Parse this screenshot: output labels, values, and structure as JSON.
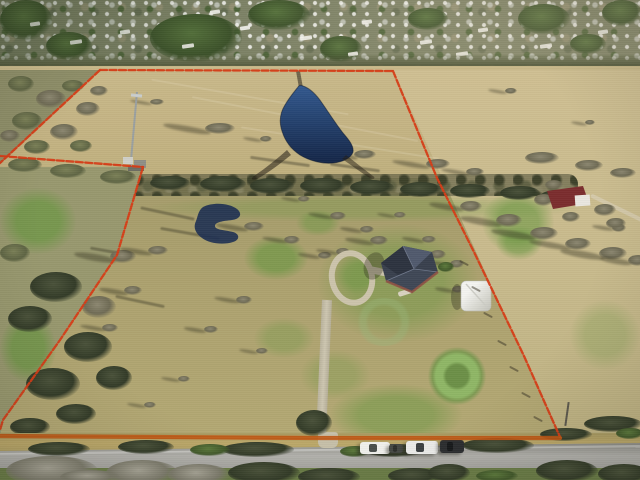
{
  "scene": {
    "kind": "aerial-drone-photograph",
    "subject": "rural acreage parcel outlined in red beside a suburban neighborhood",
    "regions": {
      "top": "dense suburban neighborhood with bare winter trees and rooftops",
      "middle": "open tan pasture with pond, tree line and cell tower",
      "bottom": "mowed homesite with house, shed, circular drive and road with parked trucks"
    }
  },
  "palette": {
    "neighborhood_base": "#7d8266",
    "field_tan": "#c6b585",
    "right_field_tan": "#ccbd92",
    "pasture_olive": "#aca26f",
    "scrub_olive": "#8e8e68",
    "lawn_green": "#679640",
    "treeline_dark": "#4a4d36",
    "pond_blue": "#2a4f86",
    "pond_blue_dark": "#16294d",
    "road_gray": "#a3a29c",
    "shoulder_tan": "#b8a468",
    "boundary_red": "#d63c16",
    "boundary_orange": "#c05713",
    "roof_charcoal": "#39404e",
    "brick": "#8f5244",
    "shed_white": "#ebebe6",
    "neighbor_roof_maroon": "#7b2d2e"
  },
  "annotation": {
    "label": "property-boundary-outline",
    "segments": {
      "top": [
        [
          100,
          70
        ],
        [
          393,
          71
        ]
      ],
      "upper_left": [
        [
          100,
          70
        ],
        [
          0,
          163
        ]
      ],
      "jog": [
        [
          0,
          156
        ],
        [
          143,
          167
        ]
      ],
      "lower_left": [
        [
          143,
          167
        ],
        [
          117,
          255
        ],
        [
          60,
          340
        ],
        [
          3,
          420
        ],
        [
          0,
          430
        ]
      ],
      "right": [
        [
          393,
          71
        ],
        [
          437,
          178
        ],
        [
          474,
          252
        ],
        [
          524,
          356
        ],
        [
          560,
          437
        ]
      ],
      "bottom": [
        [
          560,
          438
        ],
        [
          320,
          438
        ],
        [
          0,
          436
        ]
      ]
    }
  },
  "neighborhood": {
    "canopies": [
      [
        150,
        14,
        92,
        48
      ],
      [
        46,
        32,
        46,
        28
      ],
      [
        320,
        36,
        42,
        26
      ],
      [
        518,
        4,
        52,
        30
      ],
      [
        602,
        0,
        40,
        26
      ],
      [
        248,
        0,
        62,
        30
      ],
      [
        0,
        0,
        52,
        40
      ],
      [
        408,
        8,
        40,
        22
      ],
      [
        570,
        34,
        36,
        20
      ]
    ],
    "roofs": [
      [
        30,
        22,
        10,
        4
      ],
      [
        70,
        40,
        12,
        4
      ],
      [
        120,
        30,
        10,
        4
      ],
      [
        182,
        44,
        12,
        4
      ],
      [
        240,
        26,
        10,
        4
      ],
      [
        300,
        36,
        12,
        4
      ],
      [
        362,
        20,
        10,
        4
      ],
      [
        420,
        40,
        12,
        4
      ],
      [
        478,
        28,
        10,
        4
      ],
      [
        540,
        44,
        12,
        4
      ],
      [
        598,
        30,
        10,
        4
      ],
      [
        456,
        52,
        12,
        4
      ],
      [
        210,
        10,
        10,
        4
      ],
      [
        348,
        52,
        10,
        4
      ]
    ]
  },
  "vegetation": {
    "land_clumps": [
      [
        205,
        123,
        30,
        11,
        "bare",
        1
      ],
      [
        298,
        119,
        13,
        6,
        "bare",
        1
      ],
      [
        150,
        99,
        14,
        6,
        "bare",
        1
      ],
      [
        316,
        145,
        19,
        8,
        "bare",
        1
      ],
      [
        354,
        150,
        22,
        9,
        "bare",
        1
      ],
      [
        426,
        159,
        24,
        10,
        "bare",
        1
      ],
      [
        260,
        136,
        12,
        6,
        "bare",
        1
      ],
      [
        466,
        168,
        18,
        8,
        "bare",
        1
      ],
      [
        460,
        201,
        22,
        11,
        "bare",
        1
      ],
      [
        496,
        214,
        26,
        13,
        "bare",
        1
      ],
      [
        530,
        227,
        28,
        13,
        "bare",
        1
      ],
      [
        565,
        238,
        26,
        12,
        "bare",
        1
      ],
      [
        599,
        247,
        28,
        13,
        "bare",
        1
      ],
      [
        628,
        255,
        20,
        11,
        "bare",
        1
      ],
      [
        612,
        224,
        14,
        8,
        "bare",
        1
      ],
      [
        505,
        88,
        12,
        6,
        "bare",
        1
      ],
      [
        585,
        120,
        10,
        5,
        "bare",
        1
      ],
      [
        525,
        152,
        34,
        12,
        "bare",
        0
      ],
      [
        575,
        160,
        28,
        11,
        "bare",
        0
      ],
      [
        610,
        168,
        26,
        10,
        "bare",
        0
      ],
      [
        200,
        176,
        46,
        16,
        "dark",
        0
      ],
      [
        250,
        178,
        44,
        16,
        "dark",
        0
      ],
      [
        300,
        178,
        46,
        16,
        "dark",
        0
      ],
      [
        350,
        180,
        44,
        15,
        "dark",
        0
      ],
      [
        400,
        182,
        42,
        15,
        "dark",
        0
      ],
      [
        450,
        184,
        40,
        14,
        "dark",
        0
      ],
      [
        500,
        186,
        40,
        14,
        "dark",
        0
      ],
      [
        150,
        176,
        40,
        14,
        "dark",
        0
      ],
      [
        100,
        170,
        36,
        14,
        "scrub",
        0
      ],
      [
        50,
        164,
        36,
        14,
        "scrub",
        0
      ],
      [
        8,
        158,
        34,
        14,
        "scrub",
        0
      ],
      [
        540,
        190,
        36,
        13,
        "dark",
        0
      ],
      [
        8,
        76,
        26,
        16,
        "scrub",
        0
      ],
      [
        36,
        90,
        30,
        18,
        "bare",
        0
      ],
      [
        12,
        112,
        30,
        18,
        "scrub",
        0
      ],
      [
        50,
        124,
        28,
        16,
        "bare",
        0
      ],
      [
        24,
        140,
        26,
        14,
        "scrub",
        0
      ],
      [
        76,
        102,
        24,
        14,
        "bare",
        0
      ],
      [
        62,
        80,
        22,
        12,
        "scrub",
        0
      ],
      [
        90,
        86,
        18,
        10,
        "bare",
        0
      ],
      [
        0,
        130,
        20,
        12,
        "bare",
        0
      ],
      [
        70,
        140,
        22,
        12,
        "scrub",
        0
      ],
      [
        30,
        272,
        52,
        30,
        "dark",
        0
      ],
      [
        8,
        306,
        44,
        26,
        "dark",
        0
      ],
      [
        64,
        332,
        48,
        30,
        "dark",
        0
      ],
      [
        26,
        368,
        54,
        32,
        "dark",
        0
      ],
      [
        82,
        296,
        34,
        22,
        "bare",
        0
      ],
      [
        96,
        366,
        36,
        24,
        "dark",
        0
      ],
      [
        0,
        244,
        30,
        18,
        "scrub",
        0
      ],
      [
        56,
        404,
        40,
        20,
        "dark",
        0
      ],
      [
        10,
        418,
        40,
        18,
        "dark",
        0
      ],
      [
        110,
        250,
        26,
        13,
        "bare",
        1
      ],
      [
        148,
        246,
        20,
        9,
        "bare",
        1
      ],
      [
        124,
        286,
        18,
        9,
        "bare",
        1
      ],
      [
        102,
        324,
        16,
        8,
        "bare",
        1
      ],
      [
        244,
        222,
        20,
        9,
        "bare",
        1
      ],
      [
        284,
        236,
        16,
        8,
        "bare",
        1
      ],
      [
        330,
        212,
        16,
        8,
        "bare",
        1
      ],
      [
        298,
        196,
        12,
        6,
        "bare",
        1
      ],
      [
        360,
        226,
        14,
        7,
        "bare",
        1
      ],
      [
        394,
        212,
        12,
        6,
        "bare",
        1
      ],
      [
        422,
        236,
        14,
        7,
        "bare",
        1
      ],
      [
        450,
        260,
        14,
        8,
        "bare",
        1
      ],
      [
        236,
        296,
        16,
        8,
        "bare",
        1
      ],
      [
        204,
        326,
        14,
        7,
        "bare",
        1
      ],
      [
        256,
        348,
        12,
        6,
        "bare",
        1
      ],
      [
        178,
        376,
        12,
        6,
        "bare",
        1
      ],
      [
        144,
        402,
        12,
        6,
        "bare",
        1
      ],
      [
        318,
        252,
        14,
        7,
        "bare",
        1
      ],
      [
        370,
        236,
        18,
        9,
        "bare",
        1
      ],
      [
        430,
        250,
        16,
        9,
        "bare",
        1
      ],
      [
        336,
        248,
        14,
        8,
        "bare",
        1
      ],
      [
        452,
        286,
        12,
        7,
        "bare",
        1
      ],
      [
        438,
        262,
        16,
        10,
        "green",
        0
      ],
      [
        534,
        194,
        20,
        12,
        "bare",
        0
      ],
      [
        594,
        204,
        22,
        12,
        "bare",
        0
      ],
      [
        562,
        212,
        18,
        10,
        "bare",
        0
      ],
      [
        606,
        218,
        20,
        11,
        "bare",
        0
      ],
      [
        545,
        180,
        18,
        10,
        "bare",
        0
      ]
    ],
    "roadside_clumps": [
      [
        28,
        442,
        62,
        14,
        "dark",
        0
      ],
      [
        118,
        440,
        56,
        14,
        "dark",
        0
      ],
      [
        222,
        442,
        72,
        15,
        "dark",
        0
      ],
      [
        296,
        410,
        36,
        26,
        "dark",
        0
      ],
      [
        364,
        444,
        62,
        13,
        "dark",
        0
      ],
      [
        462,
        438,
        72,
        15,
        "dark",
        0
      ],
      [
        540,
        428,
        52,
        13,
        "dark",
        0
      ],
      [
        584,
        416,
        58,
        16,
        "dark",
        0
      ],
      [
        616,
        428,
        28,
        11,
        "green",
        0
      ],
      [
        190,
        444,
        40,
        12,
        "green",
        0
      ],
      [
        340,
        446,
        30,
        11,
        "green",
        0
      ]
    ],
    "overhang_clumps": [
      [
        6,
        456,
        92,
        30,
        "gray",
        0
      ],
      [
        106,
        460,
        72,
        26,
        "gray",
        0
      ],
      [
        168,
        464,
        62,
        22,
        "gray",
        0
      ],
      [
        228,
        462,
        72,
        22,
        "dark",
        0
      ],
      [
        298,
        468,
        62,
        18,
        "dark",
        0
      ],
      [
        388,
        468,
        52,
        16,
        "dark",
        0
      ],
      [
        428,
        464,
        42,
        18,
        "dark",
        0
      ],
      [
        536,
        460,
        62,
        22,
        "dark",
        0
      ],
      [
        598,
        464,
        52,
        20,
        "dark",
        0
      ],
      [
        476,
        470,
        42,
        12,
        "green",
        0
      ],
      [
        60,
        470,
        60,
        14,
        "gray",
        0
      ]
    ],
    "green_patches": [
      [
        244,
        236,
        64,
        44,
        0.7
      ],
      [
        296,
        210,
        44,
        26,
        0.5
      ],
      [
        318,
        224,
        160,
        118,
        0.5
      ],
      [
        330,
        384,
        132,
        62,
        0.55
      ],
      [
        482,
        190,
        72,
        64,
        0.65
      ],
      [
        496,
        226,
        46,
        34,
        0.55
      ],
      [
        0,
        188,
        76,
        66,
        0.75
      ],
      [
        0,
        314,
        56,
        68,
        0.75
      ],
      [
        150,
        194,
        430,
        28,
        0.3
      ],
      [
        336,
        256,
        44,
        38,
        0.45
      ],
      [
        254,
        318,
        60,
        40,
        0.35
      ],
      [
        300,
        350,
        70,
        50,
        0.3
      ],
      [
        570,
        300,
        70,
        70,
        0.28
      ]
    ]
  },
  "light_streaks": [
    [
      150,
      96,
      200,
      10
    ],
    [
      190,
      118,
      230,
      11
    ],
    [
      240,
      142,
      200,
      9
    ]
  ],
  "shadow_streaks": [
    [
      140,
      212,
      55,
      12
    ],
    [
      160,
      232,
      60,
      10
    ],
    [
      115,
      300,
      50,
      12
    ],
    [
      90,
      250,
      40,
      10
    ],
    [
      250,
      160,
      60,
      8
    ],
    [
      330,
      166,
      50,
      8
    ]
  ],
  "fence_ticks": [
    [
      470,
      262
    ],
    [
      482,
      288
    ],
    [
      494,
      314
    ],
    [
      508,
      342
    ],
    [
      520,
      368
    ],
    [
      532,
      394
    ],
    [
      544,
      418
    ]
  ],
  "vehicles": [
    {
      "name": "white-pickup-truck",
      "x": 360,
      "y": 442,
      "w": 30,
      "h": 12,
      "body": "#f0f0ec",
      "detail": "#4a4f4c"
    },
    {
      "name": "utility-trailer",
      "x": 389,
      "y": 444,
      "w": 14,
      "h": 9,
      "body": "#454843",
      "detail": "#2e302c"
    },
    {
      "name": "white-pickup-truck",
      "x": 406,
      "y": 441,
      "w": 32,
      "h": 13,
      "body": "#ececea",
      "detail": "#3c4042"
    },
    {
      "name": "dark-vehicle",
      "x": 440,
      "y": 440,
      "w": 24,
      "h": 13,
      "body": "#2c2e30",
      "detail": "#17191b"
    }
  ]
}
